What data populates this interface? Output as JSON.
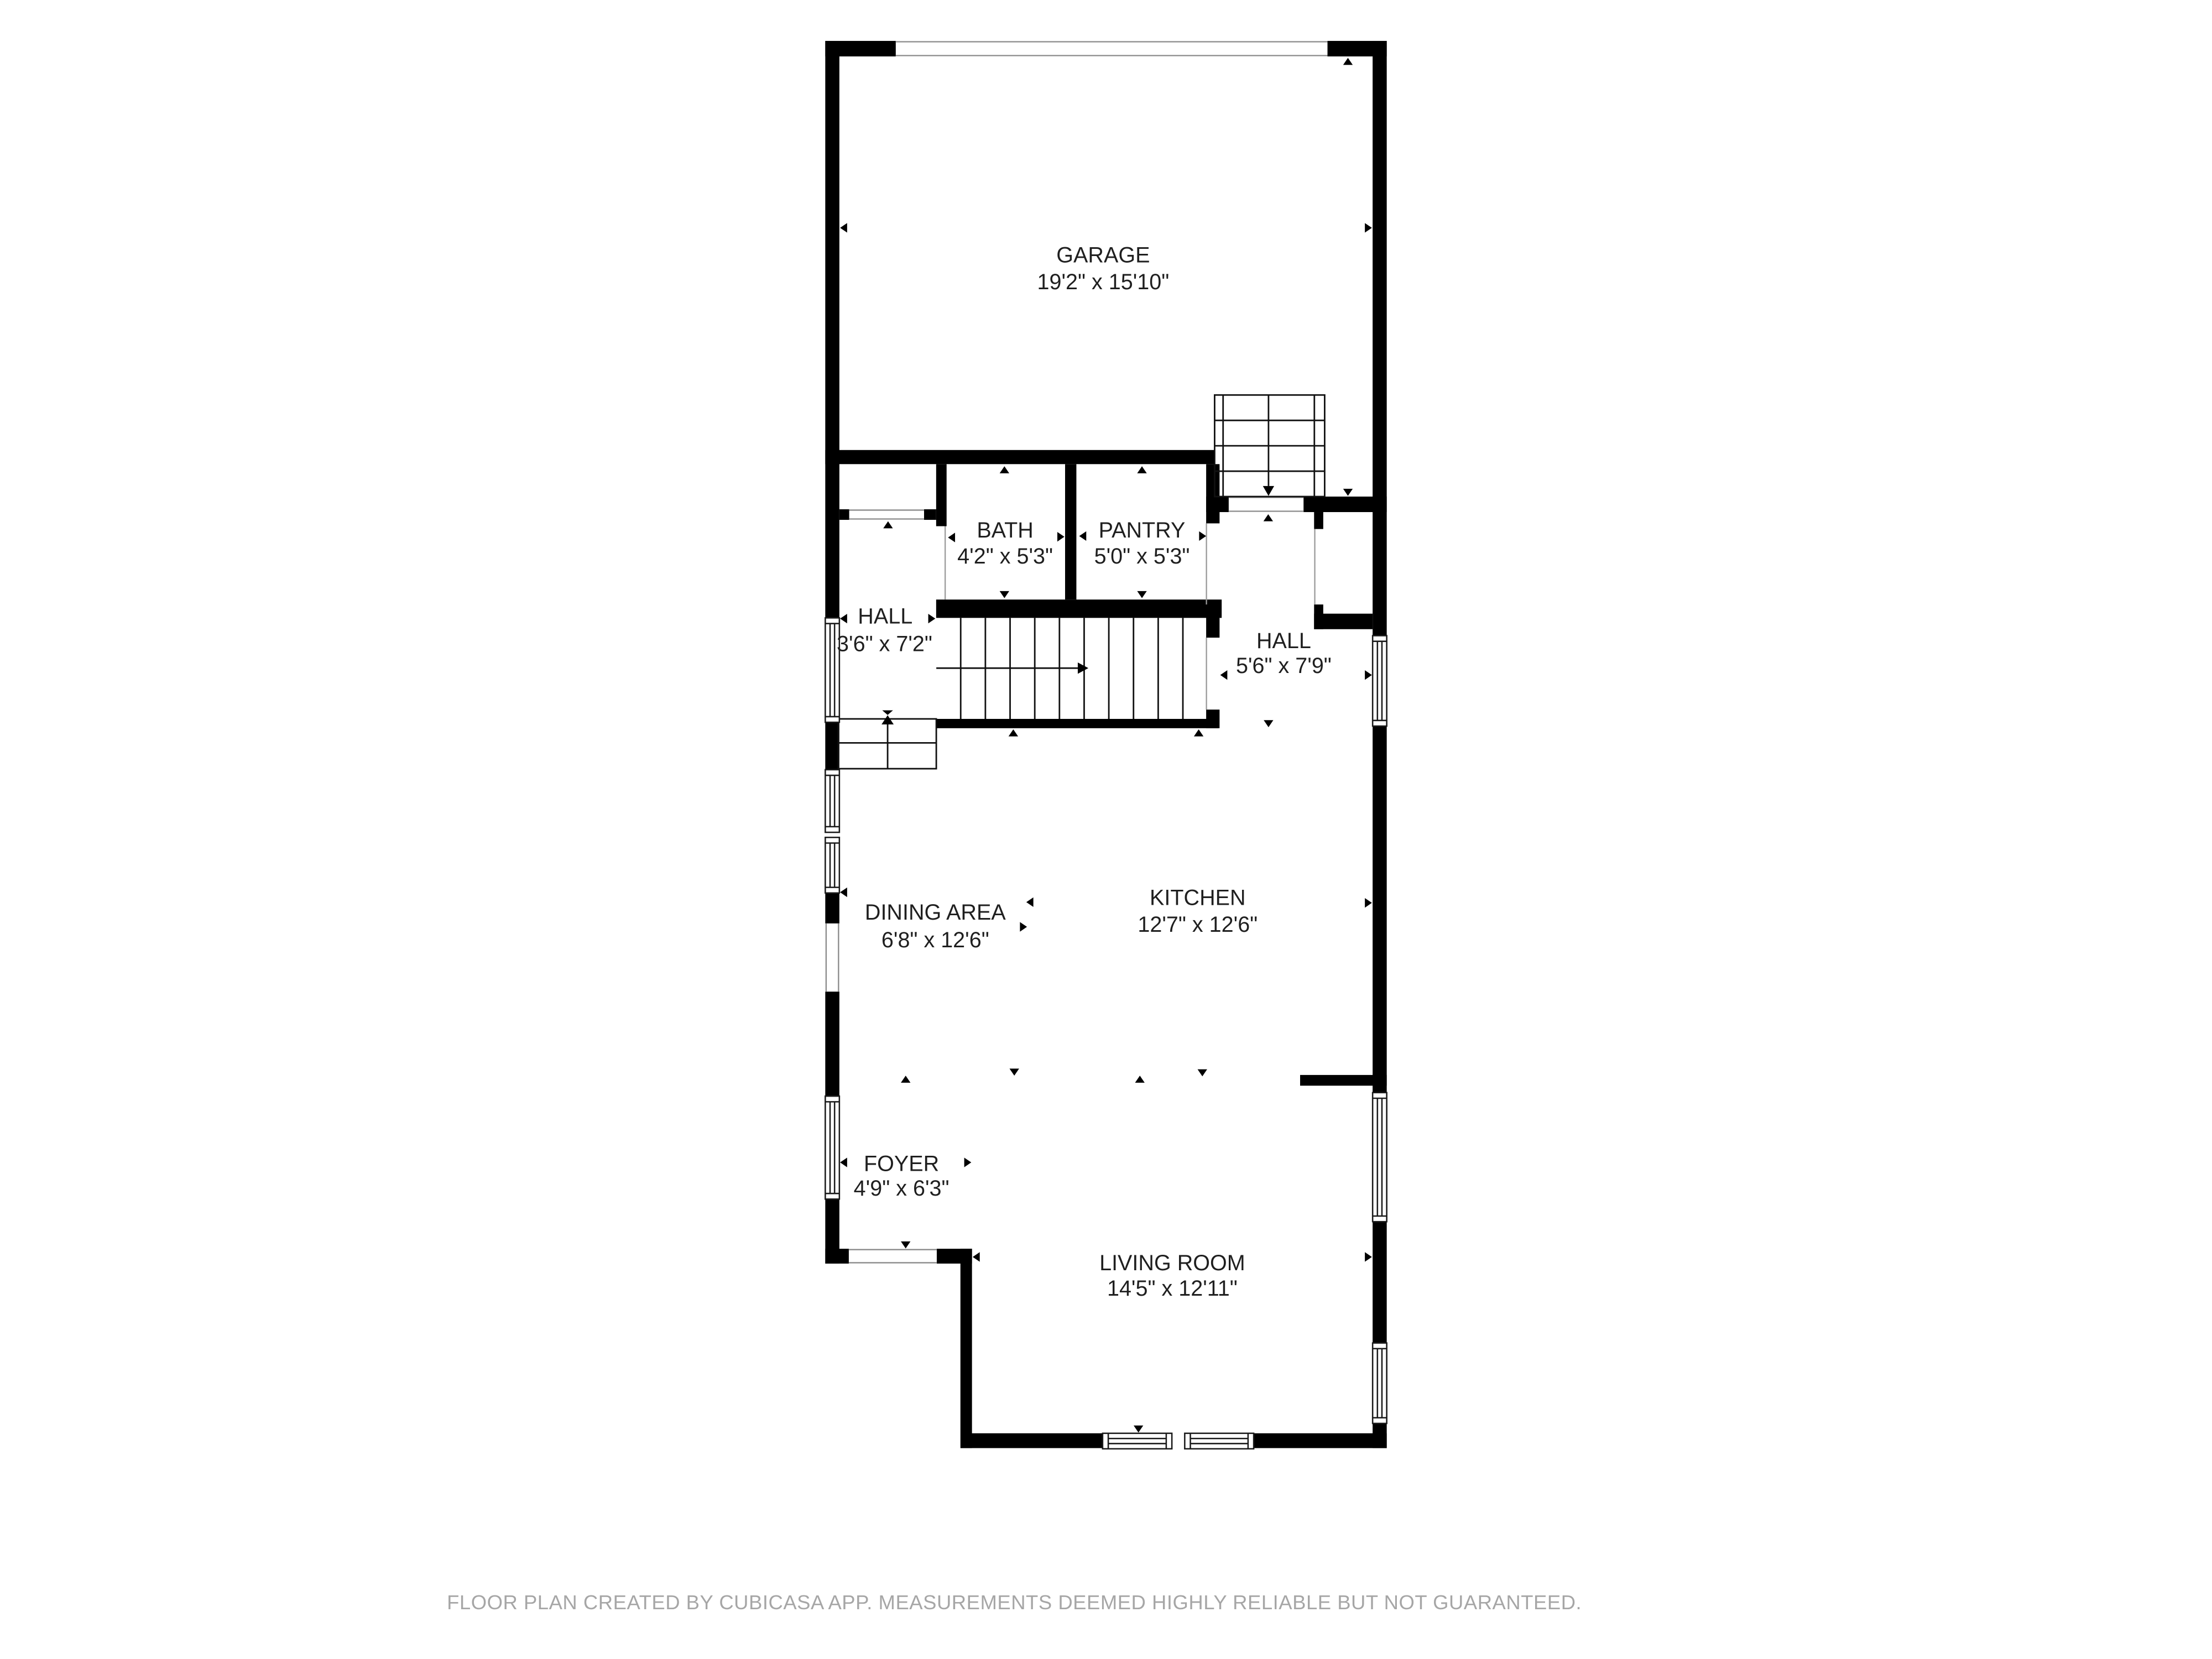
{
  "app": "CubiCasa floor plan",
  "rooms": [
    {
      "id": "garage",
      "name": "GARAGE",
      "dims": "19'2\" x 15'10\""
    },
    {
      "id": "bath",
      "name": "BATH",
      "dims": "4'2\" x 5'3\""
    },
    {
      "id": "pantry",
      "name": "PANTRY",
      "dims": "5'0\" x 5'3\""
    },
    {
      "id": "hall-left",
      "name": "HALL",
      "dims": "3'6\" x 7'2\""
    },
    {
      "id": "hall-right",
      "name": "HALL",
      "dims": "5'6\" x 7'9\""
    },
    {
      "id": "dining",
      "name": "DINING AREA",
      "dims": "6'8\" x 12'6\""
    },
    {
      "id": "kitchen",
      "name": "KITCHEN",
      "dims": "12'7\" x 12'6\""
    },
    {
      "id": "foyer",
      "name": "FOYER",
      "dims": "4'9\" x 6'3\""
    },
    {
      "id": "living",
      "name": "LIVING ROOM",
      "dims": "14'5\" x 12'11\""
    }
  ],
  "footer": {
    "text": "FLOOR PLAN CREATED BY CUBICASA APP. MEASUREMENTS DEEMED HIGHLY RELIABLE BUT NOT GUARANTEED."
  },
  "colors": {
    "wall": "#000000",
    "room_text": "#1f1f1f",
    "footer_text": "#a6a6a6",
    "background": "#ffffff"
  }
}
